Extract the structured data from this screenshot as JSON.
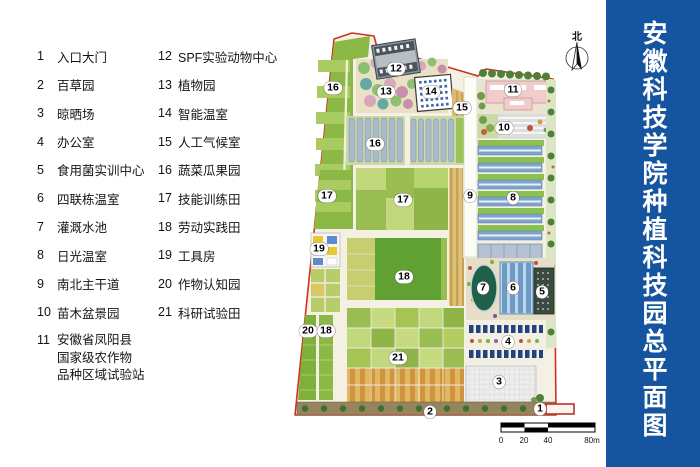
{
  "title": {
    "text": "安徽科技学院种植科技园总平面图"
  },
  "palette": {
    "title_bg": "#15549E",
    "boundary_red": "#D03020",
    "pond_green": "#205F4C"
  },
  "legend": {
    "col1": [
      {
        "num": "1",
        "label": "入口大门"
      },
      {
        "num": "2",
        "label": "百草园"
      },
      {
        "num": "3",
        "label": "晾晒场"
      },
      {
        "num": "4",
        "label": "办公室"
      },
      {
        "num": "5",
        "label": "食用菌实训中心"
      },
      {
        "num": "6",
        "label": "四联栋温室"
      },
      {
        "num": "7",
        "label": "灌溉水池"
      },
      {
        "num": "8",
        "label": "日光温室"
      },
      {
        "num": "9",
        "label": "南北主干道"
      },
      {
        "num": "10",
        "label": "苗木盆景园"
      },
      {
        "num": "11",
        "label": "安徽省凤阳县\n国家级农作物\n品种区域试验站"
      }
    ],
    "col2": [
      {
        "num": "12",
        "label": "SPF实验动物中心"
      },
      {
        "num": "13",
        "label": "植物园"
      },
      {
        "num": "14",
        "label": "智能温室"
      },
      {
        "num": "15",
        "label": "人工气候室"
      },
      {
        "num": "16",
        "label": "蔬菜瓜果园"
      },
      {
        "num": "17",
        "label": "技能训练田"
      },
      {
        "num": "18",
        "label": "劳动实践田"
      },
      {
        "num": "19",
        "label": "工具房"
      },
      {
        "num": "20",
        "label": "作物认知园"
      },
      {
        "num": "21",
        "label": "科研试验田"
      }
    ]
  },
  "map": {
    "north_label": "北",
    "scale": {
      "t0": "0",
      "t1": "20",
      "t2": "40",
      "t3": "80m"
    },
    "labels": [
      {
        "n": "16",
        "x": 333,
        "y": 88
      },
      {
        "n": "12",
        "x": 396,
        "y": 69
      },
      {
        "n": "13",
        "x": 386,
        "y": 92
      },
      {
        "n": "14",
        "x": 431,
        "y": 92
      },
      {
        "n": "15",
        "x": 462,
        "y": 108
      },
      {
        "n": "11",
        "x": 513,
        "y": 90
      },
      {
        "n": "10",
        "x": 504,
        "y": 128
      },
      {
        "n": "16",
        "x": 375,
        "y": 144
      },
      {
        "n": "17",
        "x": 327,
        "y": 196
      },
      {
        "n": "17",
        "x": 403,
        "y": 200
      },
      {
        "n": "9",
        "x": 470,
        "y": 196
      },
      {
        "n": "8",
        "x": 513,
        "y": 198
      },
      {
        "n": "19",
        "x": 319,
        "y": 249
      },
      {
        "n": "18",
        "x": 404,
        "y": 277
      },
      {
        "n": "7",
        "x": 483,
        "y": 288
      },
      {
        "n": "6",
        "x": 513,
        "y": 288
      },
      {
        "n": "5",
        "x": 542,
        "y": 292
      },
      {
        "n": "20",
        "x": 308,
        "y": 331
      },
      {
        "n": "18",
        "x": 326,
        "y": 331
      },
      {
        "n": "4",
        "x": 508,
        "y": 342
      },
      {
        "n": "21",
        "x": 398,
        "y": 358
      },
      {
        "n": "3",
        "x": 499,
        "y": 382
      },
      {
        "n": "2",
        "x": 430,
        "y": 412
      },
      {
        "n": "1",
        "x": 540,
        "y": 409
      }
    ]
  }
}
